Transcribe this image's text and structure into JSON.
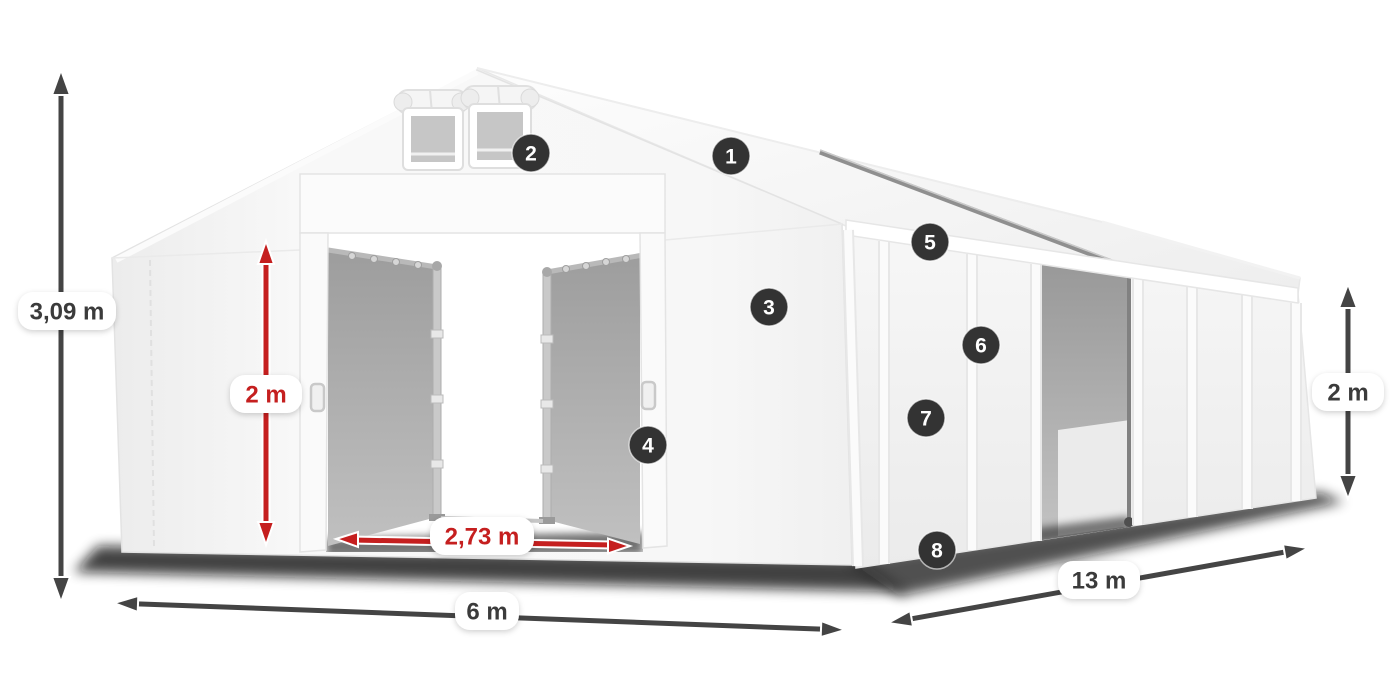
{
  "illustration": {
    "subject": "storage-tent-dimension-diagram",
    "view": "front-left perspective with numbered feature callouts"
  },
  "badges": [
    "1",
    "2",
    "3",
    "4",
    "5",
    "6",
    "7",
    "8"
  ],
  "labels": {
    "total_height": "3,09 m",
    "door_height": "2 m",
    "door_width": "2,73 m",
    "front_width": "6 m",
    "side_length": "13 m",
    "side_height": "2 m"
  },
  "colors": {
    "dimension_red": "#c51f1f",
    "dimension_gray": "#444444",
    "badge_background": "#333333",
    "badge_number": "#ffffff",
    "label_background": "#ffffff",
    "label_text": "#3b3b3b",
    "tent_fabric": "#f6f6f6",
    "interior_tarp": "#a6a6a6",
    "canvas_background": "#ffffff"
  }
}
